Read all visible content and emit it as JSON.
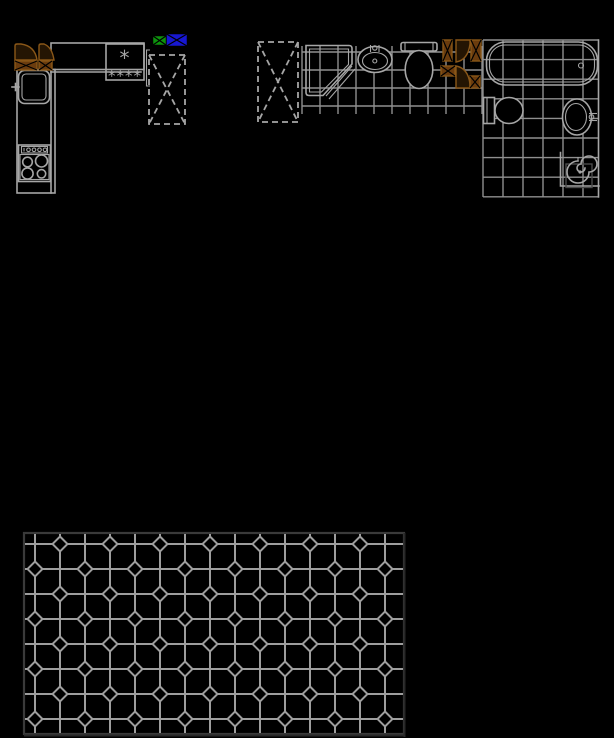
{
  "app": {
    "name": "cad-floor-plan-canvas",
    "background": "#000000"
  },
  "colors": {
    "line": "#a6a6a6",
    "grid": "#8f8f8f",
    "tile": "#9e9e9e",
    "tileBorder": "#3a3a3a",
    "tileShadow": "#282828",
    "brown": "#8a5718",
    "brownFill": "#6b3c0e",
    "brownDark": "#241503",
    "darkBox": "#4a4a4a",
    "green": "#0d930d",
    "blue": "#1717d1"
  },
  "kitchen": {
    "hob_single_burner_symbol": "*",
    "hob_burner_row_symbol": "****"
  },
  "patterns": {
    "grids": [
      {
        "id": "middle-bath-grid",
        "v": {
          "x0": 302,
          "x1": 482,
          "dx": 18,
          "y0": 46,
          "y1": 114
        },
        "h": {
          "y0": 52,
          "y1": 106,
          "dy": 18,
          "x0": 302,
          "x1": 482
        }
      },
      {
        "id": "right-bath-grid",
        "v": {
          "x0": 483,
          "x1": 583,
          "dx": 20,
          "y0": 40,
          "y1": 197
        },
        "h": {
          "y0": 40,
          "y1": 197,
          "dy": 19.6,
          "x0": 483,
          "x1": 598.5
        }
      },
      {
        "id": "tile-grid",
        "v": {
          "x0": 35,
          "x1": 385,
          "dx": 25,
          "y0": 534,
          "y1": 733
        },
        "h": {
          "y0": 544,
          "y1": 719,
          "dy": 25,
          "x0": 25,
          "x1": 403
        }
      }
    ],
    "diamonds": {
      "id": "tile-diamonds",
      "x0": 35,
      "y0": 544,
      "step": 25,
      "cols": 15,
      "rows": 8,
      "r": 7.5
    },
    "dashed_units": [
      {
        "x": 149,
        "y": 55,
        "w": 36,
        "h": 69
      },
      {
        "x": 258,
        "y": 42,
        "w": 40,
        "h": 80
      }
    ]
  }
}
